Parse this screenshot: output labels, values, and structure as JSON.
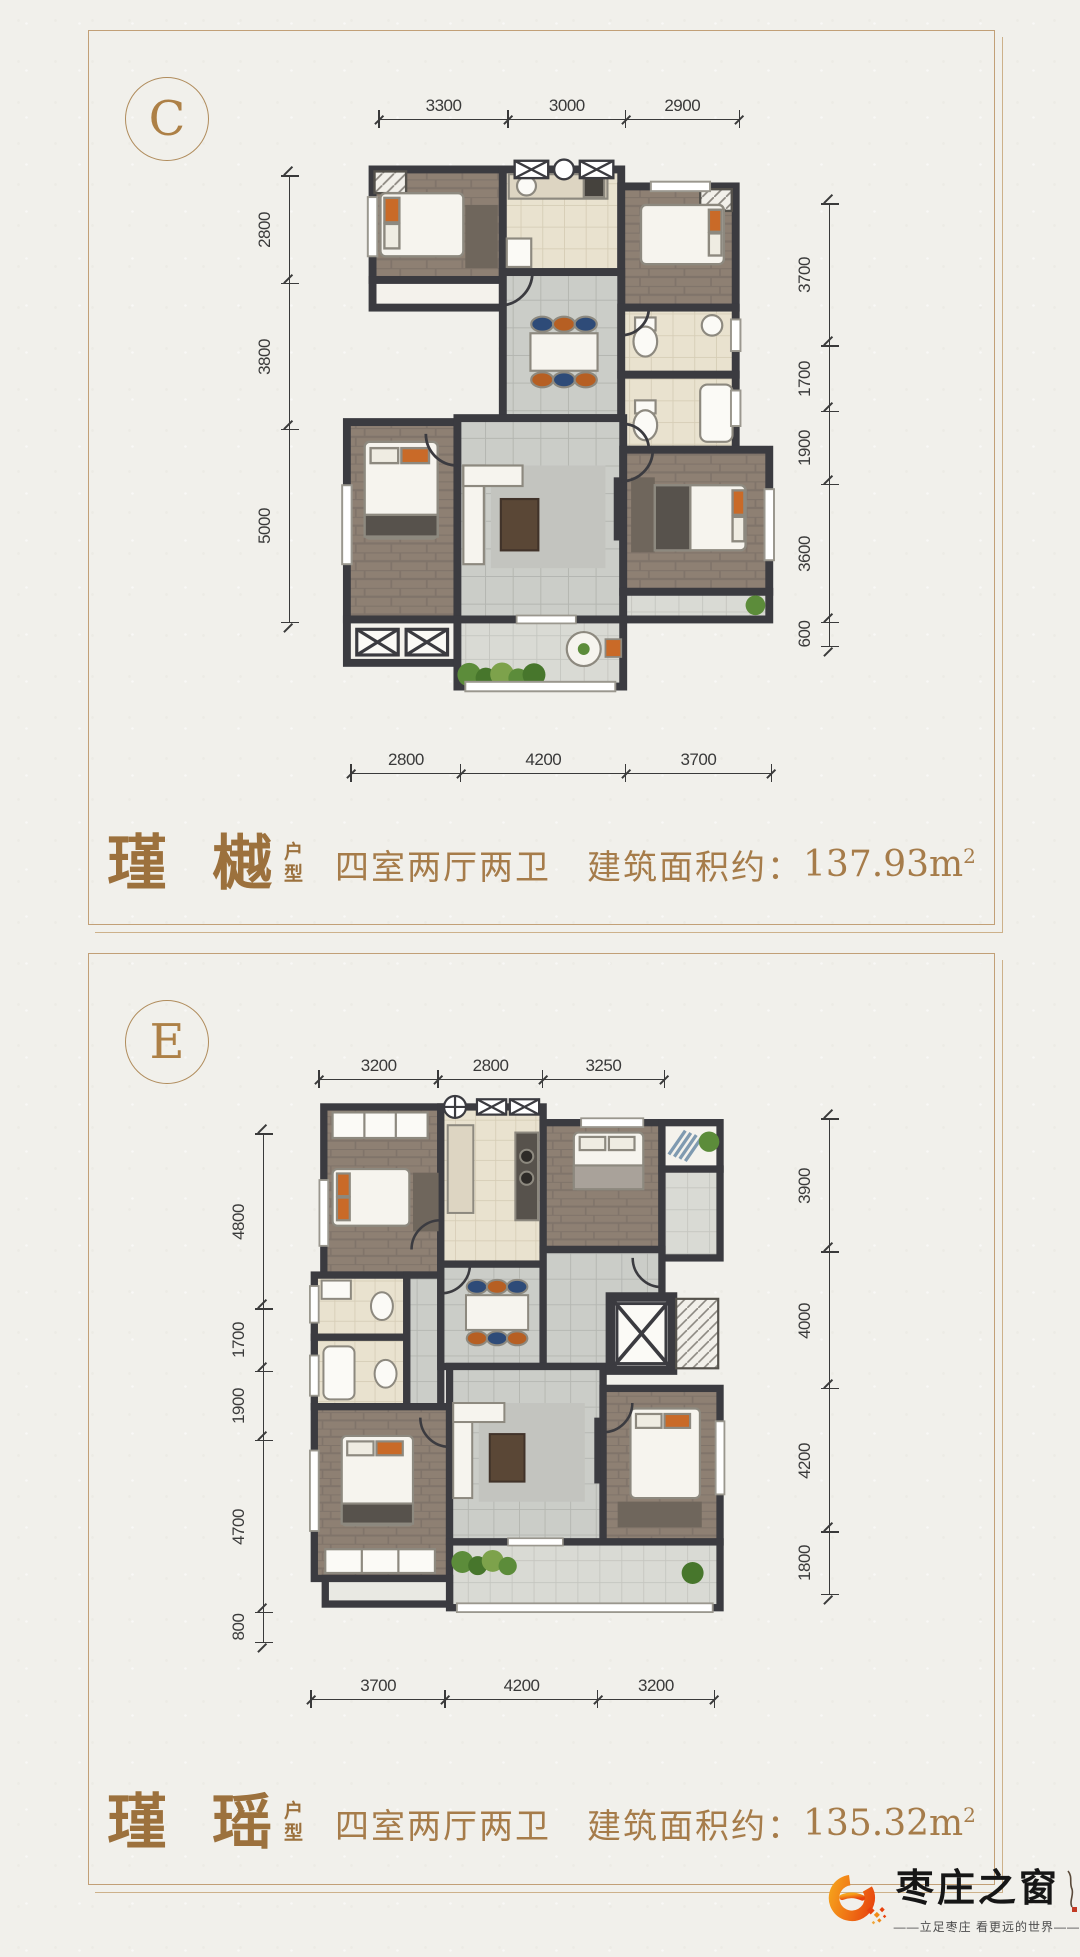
{
  "colors": {
    "page_bg": "#f1f0eb",
    "panel_border": "#c2a077",
    "title_bronze": "#9c713d",
    "dim_ink": "#3a3a3a",
    "wall": "#3b3b40",
    "logo_orange": "#e8430e",
    "logo_orange_light": "#f6a31c"
  },
  "panels": [
    {
      "badge": "C",
      "dims": {
        "top": [
          "3300",
          "3000",
          "2900"
        ],
        "left": [
          "2800",
          "3800",
          "5000"
        ],
        "right": [
          "3700",
          "1700",
          "1900",
          "3600",
          "600"
        ],
        "bottom": [
          "2800",
          "4200",
          "3700"
        ]
      },
      "caption": {
        "name": "瑾 樾",
        "suffix": [
          "户",
          "型"
        ],
        "desc": "四室两厅两卫　建筑面积约：",
        "area": "137.93m",
        "area_sup": "2"
      }
    },
    {
      "badge": "E",
      "dims": {
        "top": [
          "3200",
          "2800",
          "3250"
        ],
        "left": [
          "4800",
          "1700",
          "1900",
          "4700",
          "800"
        ],
        "right": [
          "3900",
          "4000",
          "4200",
          "1800"
        ],
        "bottom": [
          "3700",
          "4200",
          "3200"
        ]
      },
      "caption": {
        "name": "瑾 瑶",
        "suffix": [
          "户",
          "型"
        ],
        "desc": "四室两厅两卫　建筑面积约：",
        "area": "135.32m",
        "area_sup": "2"
      }
    }
  ],
  "logo": {
    "brand": "枣庄之窗",
    "tagline": "——立足枣庄  看更远的世界——"
  }
}
